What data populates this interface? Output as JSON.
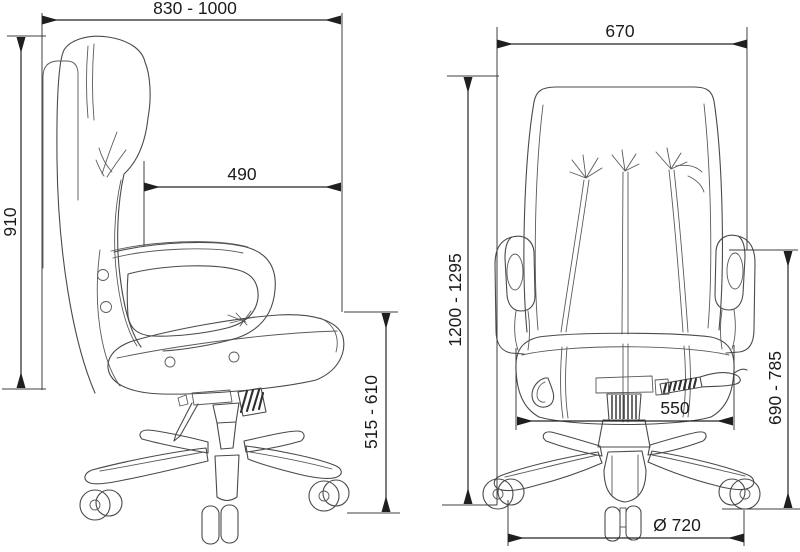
{
  "drawing": {
    "type": "technical-dimension-drawing",
    "subject": "office chair",
    "background_color": "#ffffff",
    "line_color": "#4a4a4a",
    "dimension_color": "#242424"
  },
  "side_view": {
    "name": "chair-side-view",
    "dimensions": [
      {
        "id": "overall-depth",
        "label": "830 - 1000"
      },
      {
        "id": "backrest-height",
        "label": "910"
      },
      {
        "id": "seat-depth",
        "label": "490"
      },
      {
        "id": "seat-height",
        "label": "515 - 610"
      }
    ]
  },
  "front_view": {
    "name": "chair-front-view",
    "dimensions": [
      {
        "id": "backrest-width",
        "label": "670"
      },
      {
        "id": "overall-height",
        "label": "1200 - 1295"
      },
      {
        "id": "armrest-height",
        "label": "690 - 785"
      },
      {
        "id": "seat-width",
        "label": "550"
      },
      {
        "id": "base-diameter",
        "label": "Ø 720"
      }
    ]
  }
}
